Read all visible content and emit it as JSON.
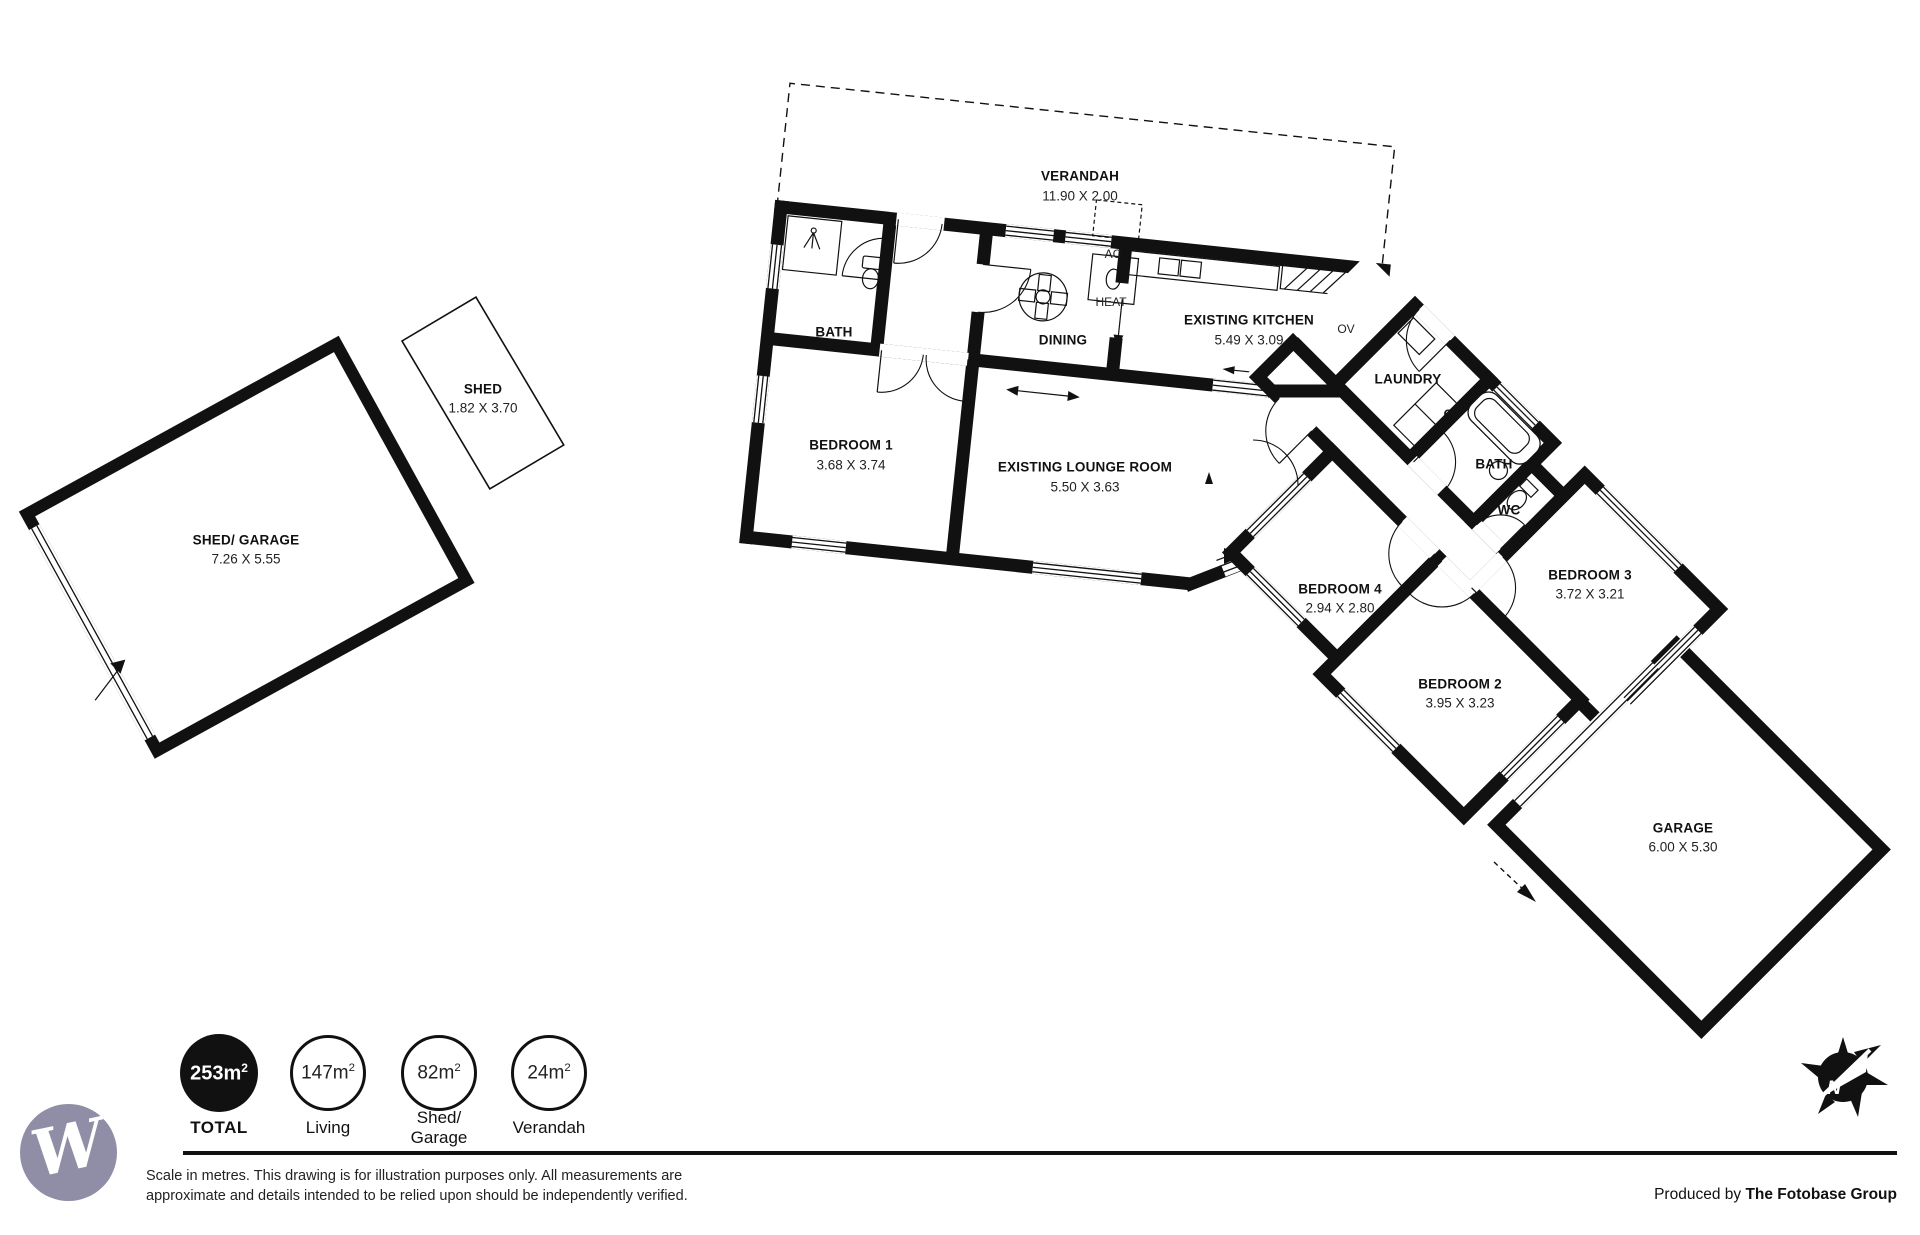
{
  "plan": {
    "rooms": {
      "verandah": {
        "name": "VERANDAH",
        "dims": "11.90 X 2.00"
      },
      "bath1": {
        "name": "BATH"
      },
      "bedroom1": {
        "name": "BEDROOM 1",
        "dims": "3.68 X 3.74"
      },
      "dining": {
        "name": "DINING"
      },
      "kitchen": {
        "name": "EXISTING KITCHEN",
        "dims": "5.49 X 3.09"
      },
      "lounge": {
        "name": "EXISTING LOUNGE ROOM",
        "dims": "5.50 X 3.63"
      },
      "laundry": {
        "name": "LAUNDRY"
      },
      "bath2": {
        "name": "BATH"
      },
      "wc": {
        "name": "WC"
      },
      "bedroom3": {
        "name": "BEDROOM 3",
        "dims": "3.72 X 3.21"
      },
      "bedroom4": {
        "name": "BEDROOM 4",
        "dims": "2.94 X 2.80"
      },
      "bedroom2": {
        "name": "BEDROOM 2",
        "dims": "3.95 X 3.23"
      },
      "garage": {
        "name": "GARAGE",
        "dims": "6.00 X 5.30"
      },
      "shedgarage": {
        "name": "SHED/ GARAGE",
        "dims": "7.26 X 5.55"
      },
      "shed": {
        "name": "SHED",
        "dims": "1.82 X 3.70"
      }
    },
    "markers": {
      "ac": "AC",
      "heat": "HEAT",
      "oven": "OV",
      "cupboard": "C",
      "north": "N"
    }
  },
  "legend": {
    "total": {
      "value": "253m",
      "sup": "2",
      "label": "TOTAL"
    },
    "living": {
      "value": "147m",
      "sup": "2",
      "label": "Living"
    },
    "shed_garage": {
      "value": "82m",
      "sup": "2",
      "label_line1": "Shed/",
      "label_line2": "Garage"
    },
    "verandah": {
      "value": "24m",
      "sup": "2",
      "label": "Verandah"
    }
  },
  "footer": {
    "disclaimer_line1": "Scale in metres. This drawing is for illustration purposes only. All measurements are",
    "disclaimer_line2": "approximate and details intended to be relied upon should be independently verified.",
    "produced_by": "Produced by ",
    "producer": "The Fotobase Group"
  },
  "logo": {
    "letter": "W"
  },
  "colors": {
    "wall": "#111111",
    "logo_circle": "#8f8ea6",
    "background": "#ffffff"
  }
}
